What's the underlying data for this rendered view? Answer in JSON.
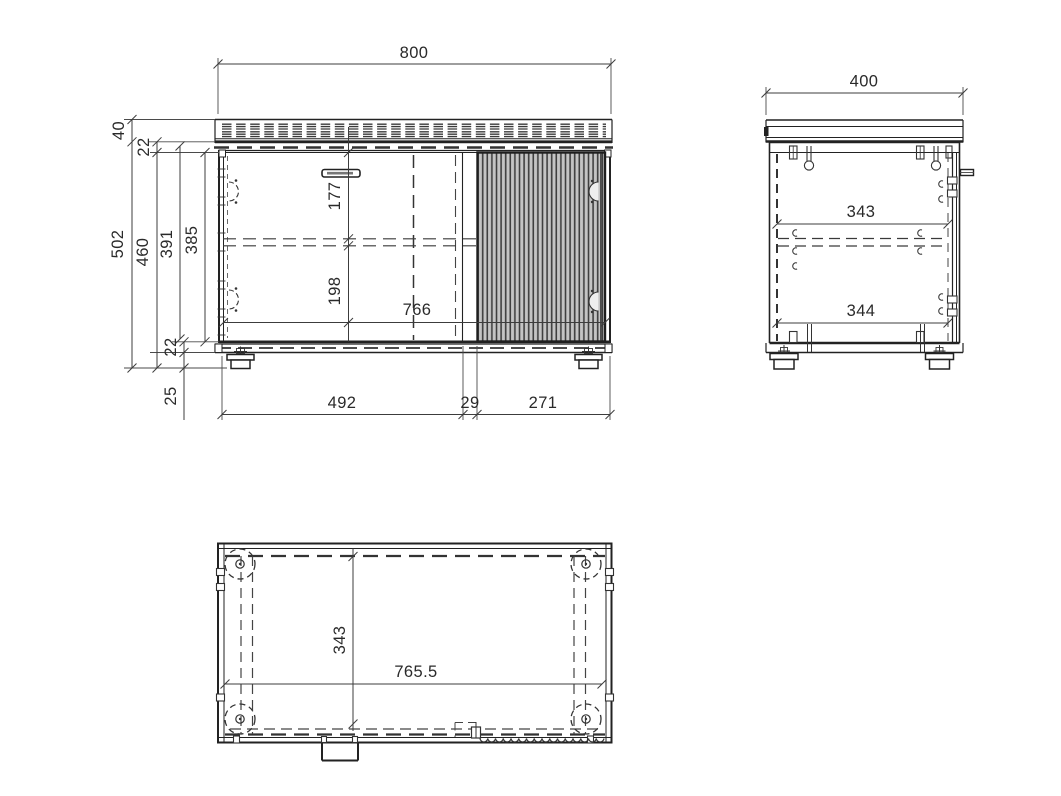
{
  "drawing": {
    "title": "cabinet-technical-drawing",
    "colors": {
      "line": "#2a2a2a",
      "background": "#ffffff",
      "fluted_fill": "#c4c4c4",
      "fluted_line": "#3f3f3f"
    },
    "views": {
      "front": {
        "dims": {
          "overall_width": "800",
          "top_thickness": "40",
          "top_panel": "22",
          "overall_height": "502",
          "body_height": "460",
          "carcass_height": "391",
          "interior_height": "385",
          "handle_offset": "177",
          "lower_offset": "198",
          "interior_width": "766",
          "bottom_panel": "22",
          "foot_height": "25",
          "left_section": "492",
          "center_gap": "29",
          "right_section": "271"
        }
      },
      "side": {
        "dims": {
          "depth": "400",
          "upper_inner_depth": "343",
          "lower_inner_depth": "344"
        }
      },
      "bottom": {
        "dims": {
          "inner_depth": "343",
          "inner_width": "765.5"
        }
      }
    }
  }
}
